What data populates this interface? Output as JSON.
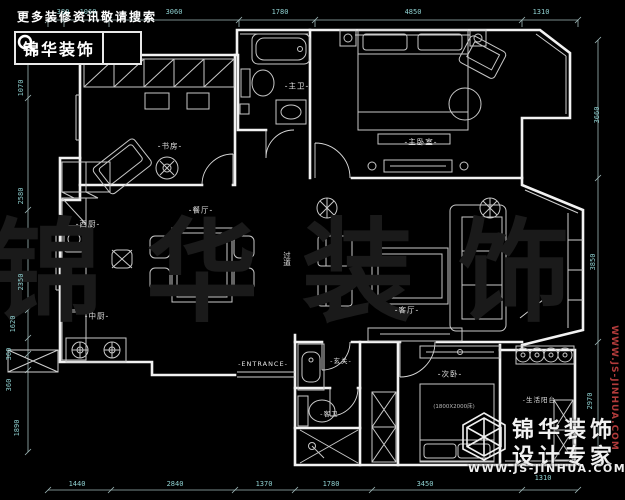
{
  "header": {
    "tagline": "更多装修资讯敬请搜索",
    "brand": "锦华装饰"
  },
  "rooms": [
    {
      "id": "study",
      "label": "-书房-"
    },
    {
      "id": "master-bath",
      "label": "-主卫-"
    },
    {
      "id": "master-bedroom",
      "label": "-主卧室-"
    },
    {
      "id": "west-kitchen",
      "label": "-西厨-"
    },
    {
      "id": "dining",
      "label": "-餐厅-"
    },
    {
      "id": "chinese-kitchen",
      "label": "-中厨-"
    },
    {
      "id": "hallway",
      "label": "过道"
    },
    {
      "id": "living",
      "label": "-客厅-"
    },
    {
      "id": "entrance",
      "label": "-ENTRANCE-"
    },
    {
      "id": "foyer",
      "label": "-玄关-"
    },
    {
      "id": "guest-bath",
      "label": "-客卫-"
    },
    {
      "id": "second-bedroom",
      "label": "-次卧-"
    },
    {
      "id": "second-bedroom-note",
      "label": "(1800X2000床)"
    },
    {
      "id": "service-balcony",
      "label": "-生活阳台-"
    }
  ],
  "dimensions": {
    "top": [
      "380",
      "1060",
      "3060",
      "1780",
      "4850",
      "1310"
    ],
    "bottom": [
      "1440",
      "2840",
      "1370",
      "1780",
      "3450",
      "1310"
    ],
    "left": [
      "1070",
      "2580",
      "2350",
      "1620",
      "360",
      "360",
      "1890"
    ],
    "right": [
      "3660",
      "3850",
      "2970"
    ]
  },
  "watermark": {
    "faint": "锦华装饰",
    "brand_line1": "锦华装饰",
    "brand_line2": "设计专家",
    "url": "WWW.JS-JINHUA.COM",
    "side_url": "WWW.JS-JINHUA.COM"
  },
  "colors": {
    "background": "#000000",
    "wall_line": "#f2f2f2",
    "dimension_text": "#8ecfcf",
    "watermark_red": "#b23b3b"
  }
}
